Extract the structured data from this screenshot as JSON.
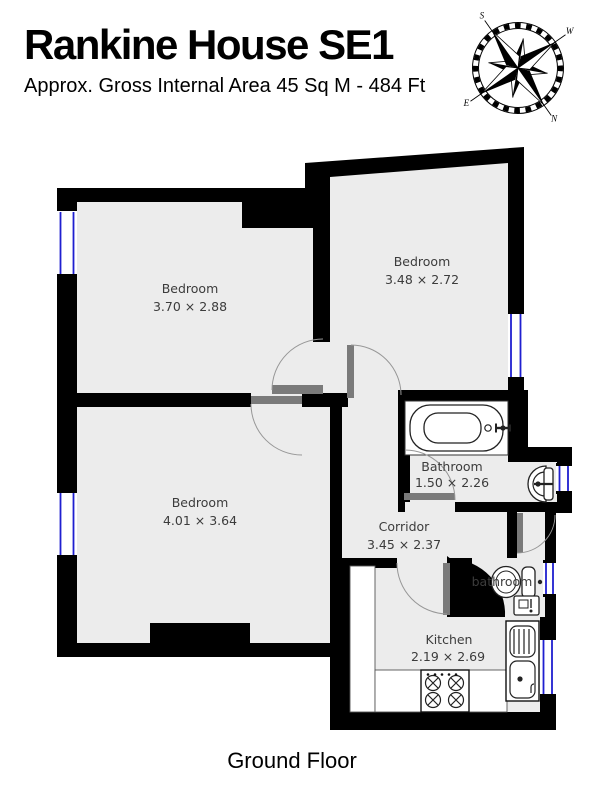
{
  "header": {
    "title": "Rankine House SE1",
    "subtitle": "Approx. Gross Internal Area 45 Sq M - 484 Ft"
  },
  "floor_label": "Ground Floor",
  "compass": {
    "n": "N",
    "e": "E",
    "s": "S",
    "w": "W"
  },
  "rooms": {
    "bedroom_top_left": {
      "name": "Bedroom",
      "dims": "3.70 × 2.88"
    },
    "bedroom_top_right": {
      "name": "Bedroom",
      "dims": "3.48 × 2.72"
    },
    "bedroom_lower_left": {
      "name": "Bedroom",
      "dims": "4.01 × 3.64"
    },
    "bathroom": {
      "name": "Bathroom",
      "dims": "1.50 × 2.26"
    },
    "corridor": {
      "name": "Corridor",
      "dims": "3.45 × 2.37"
    },
    "bathroom_small": {
      "name": "bathroom"
    },
    "kitchen": {
      "name": "Kitchen",
      "dims": "2.19 × 2.69"
    }
  },
  "colors": {
    "wall": "#000000",
    "floor": "#ececec",
    "window": "#1f1fd0",
    "door_leaf": "#7a7a7a",
    "label": "#3c3c3c"
  }
}
